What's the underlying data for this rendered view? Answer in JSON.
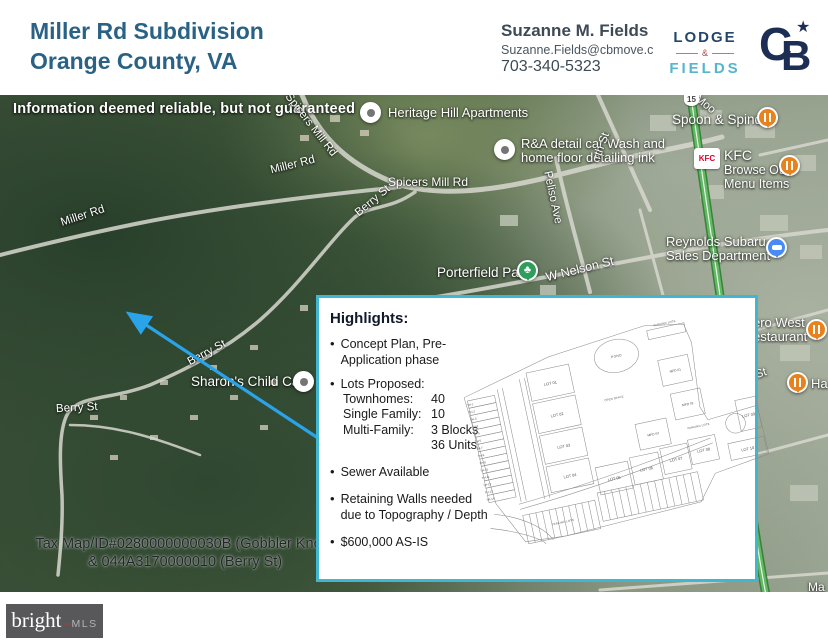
{
  "colors": {
    "title_blue": "#2a6285",
    "lodge_navy": "#24466b",
    "fields_teal": "#55b6ce",
    "cb_navy": "#1c2e54",
    "accent_teal": "#41b6d0",
    "arrow_blue": "#2aa3e8",
    "dining_orange": "#e8821e",
    "park_green": "#2e9e5b",
    "poi_blue": "#4a8af4",
    "kfc_red": "#e4002b",
    "footer_gray": "#58585a"
  },
  "header": {
    "title_line1": "Miller Rd Subdivision",
    "title_line2": "Orange County, VA",
    "agent_name": "Suzanne M. Fields",
    "agent_email": "Suzanne.Fields@cbmove.c",
    "agent_phone": "703-340-5323",
    "brokerage_word1": "LODGE",
    "brokerage_amp": "&",
    "brokerage_word2": "FIELDS",
    "cb_letter_c": "C",
    "cb_letter_b": "B",
    "cb_star": "★"
  },
  "map": {
    "disclaimer": "Information deemed reliable, but not guaranteed",
    "pois": {
      "heritage": "Heritage Hill Apartments",
      "randa_line1": "R&A detail car Wash and",
      "randa_line2": "home floor detailing ink",
      "spoon": "Spoon & Spindle",
      "kfc": "KFC",
      "kfc_menu_line1": "Browse Our",
      "kfc_menu_line2": "Menu Items",
      "porterfield": "Porterfield Park",
      "reynolds_line1": "Reynolds Subaru",
      "reynolds_line2": "Sales Department",
      "sharons": "Sharon's Child Care",
      "west_line1": "ero West",
      "west_line2": "estaurant",
      "ha_partial": "Ha",
      "ma_partial": "Ma"
    },
    "roads": {
      "spicers_diag": "Spicers Mill Rd",
      "spicers": "Spicers Mill Rd",
      "miller_a": "Miller Rd",
      "miller_b": "Miller Rd",
      "berry_a": "Berry St",
      "berry_b": "Berry St",
      "berry_c": "Berry St",
      "nelson": "W Nelson St",
      "peliso": "Peliso Ave",
      "north_partial": "rth St",
      "moore_partial": "Moo",
      "on_st_partial": "on St",
      "route_shield": "15"
    },
    "tax_line1": "Tax Map/ID#0280000000030B (Gobbler Knob)",
    "tax_line2": "& 044A3170000010 (Berry St)"
  },
  "highlights": {
    "title": "Highlights:",
    "bullet1": "Concept Plan, Pre-Application phase",
    "bullet2_title": "Lots Proposed:",
    "lots_rows": [
      {
        "label": "Townhomes:",
        "value": "40"
      },
      {
        "label": "Single Family:",
        "value": "10"
      },
      {
        "label": "Multi-Family:",
        "value": "3 Blocks"
      },
      {
        "label": "",
        "value": "36 Units"
      }
    ],
    "bullet3": "Sewer Available",
    "bullet4_line1": "Retaining Walls needed",
    "bullet4_line2": "due to Topography / Depth",
    "bullet5": "$600,000 AS-IS"
  },
  "plan": {
    "pond": "POND",
    "open_space": "OPEN SPACE",
    "parking1": "PARKING LOTS",
    "parking2": "PARKING LOTS",
    "parking3": "PARKING LOTS",
    "mfd": [
      "MFD 01",
      "MFD 02",
      "MFD 03"
    ],
    "lots": [
      "LOT 01",
      "LOT 02",
      "LOT 03",
      "LOT 04",
      "LOT 05",
      "LOT 06",
      "LOT 07",
      "LOT 08",
      "LOT 09",
      "LOT 10"
    ],
    "th": [
      "TH-1",
      "TH-2",
      "TH-3",
      "TH-4",
      "TH-5",
      "TH-6",
      "TH-7",
      "TH-8",
      "TH-9",
      "TH-10",
      "TH-11",
      "TH-12",
      "TH-13",
      "TH-14"
    ]
  },
  "footer": {
    "brand": "bright",
    "tm": "™",
    "brand2": "MLS"
  }
}
